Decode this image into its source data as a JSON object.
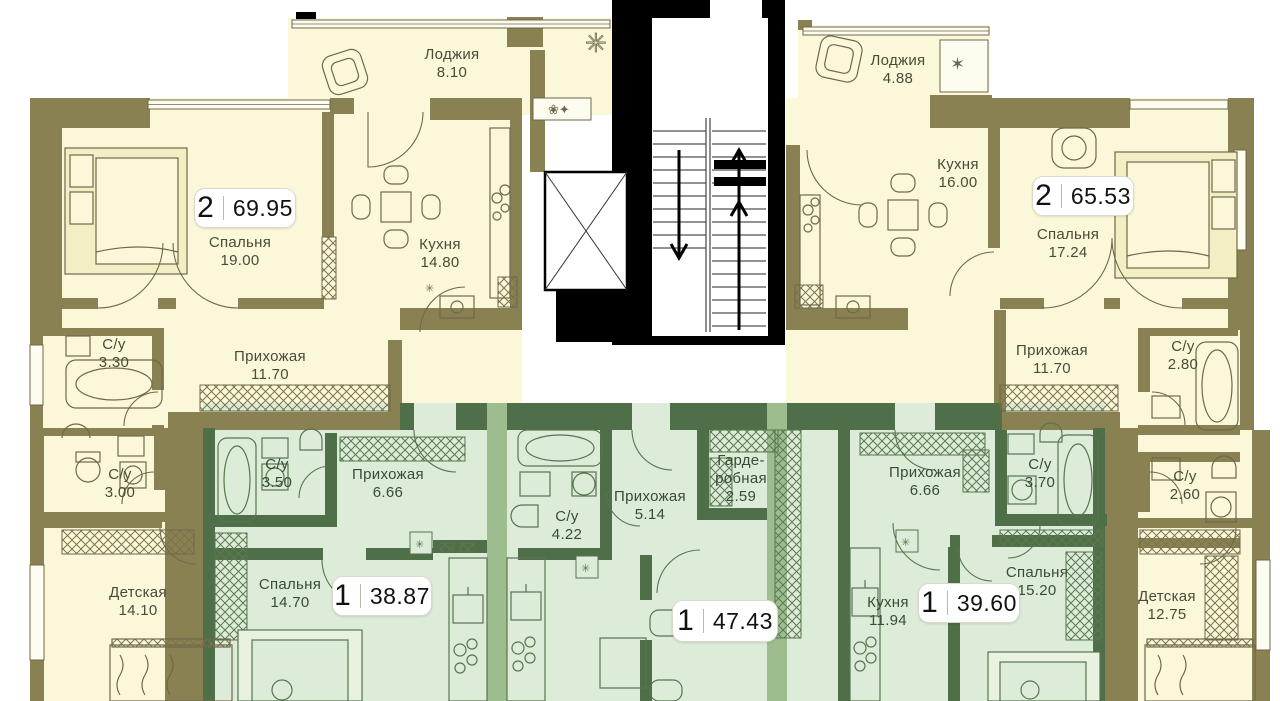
{
  "plan_title": "Типовой этаж — план квартир",
  "colors": {
    "cream": "#fbf8da",
    "olive": "#8a8153",
    "ink": "#4b4a38",
    "green-room": "#dcecd8",
    "green-wall": "#4e6f47",
    "green-mid": "#9ebd8e"
  },
  "apartments": [
    {
      "badge": {
        "rooms": "2",
        "area": "69.95"
      },
      "rooms": [
        {
          "name": "Лоджия",
          "area": "8.10"
        },
        {
          "name": "Спальня",
          "area": "19.00"
        },
        {
          "name": "Кухня",
          "area": "14.80"
        },
        {
          "name": "С/у",
          "area": "3.30"
        },
        {
          "name": "Прихожая",
          "area": "11.70"
        },
        {
          "name": "С/у",
          "area": "3.00"
        },
        {
          "name": "Детская",
          "area": "14.10"
        }
      ]
    },
    {
      "badge": {
        "rooms": "2",
        "area": "65.53"
      },
      "rooms": [
        {
          "name": "Лоджия",
          "area": "4.88"
        },
        {
          "name": "Кухня",
          "area": "16.00"
        },
        {
          "name": "Спальня",
          "area": "17.24"
        },
        {
          "name": "Прихожая",
          "area": "11.70"
        },
        {
          "name": "С/у",
          "area": "2.80"
        },
        {
          "name": "С/у",
          "area": "2.60"
        },
        {
          "name": "Детская",
          "area": "12.75"
        }
      ]
    },
    {
      "badge": {
        "rooms": "1",
        "area": "38.87"
      },
      "rooms": [
        {
          "name": "С/у",
          "area": "3.50"
        },
        {
          "name": "Прихожая",
          "area": "6.66"
        },
        {
          "name": "Спальня",
          "area": "14.70"
        }
      ]
    },
    {
      "badge": {
        "rooms": "1",
        "area": "47.43"
      },
      "rooms": [
        {
          "name": "С/у",
          "area": "4.22"
        },
        {
          "name": "Прихожая",
          "area": "5.14"
        },
        {
          "name": "Гарде-робная",
          "area": "2.59"
        }
      ]
    },
    {
      "badge": {
        "rooms": "1",
        "area": "39.60"
      },
      "rooms": [
        {
          "name": "Прихожая",
          "area": "6.66"
        },
        {
          "name": "С/у",
          "area": "3.70"
        },
        {
          "name": "Кухня",
          "area": "11.94"
        },
        {
          "name": "Спальня",
          "area": "15.20"
        }
      ]
    }
  ]
}
